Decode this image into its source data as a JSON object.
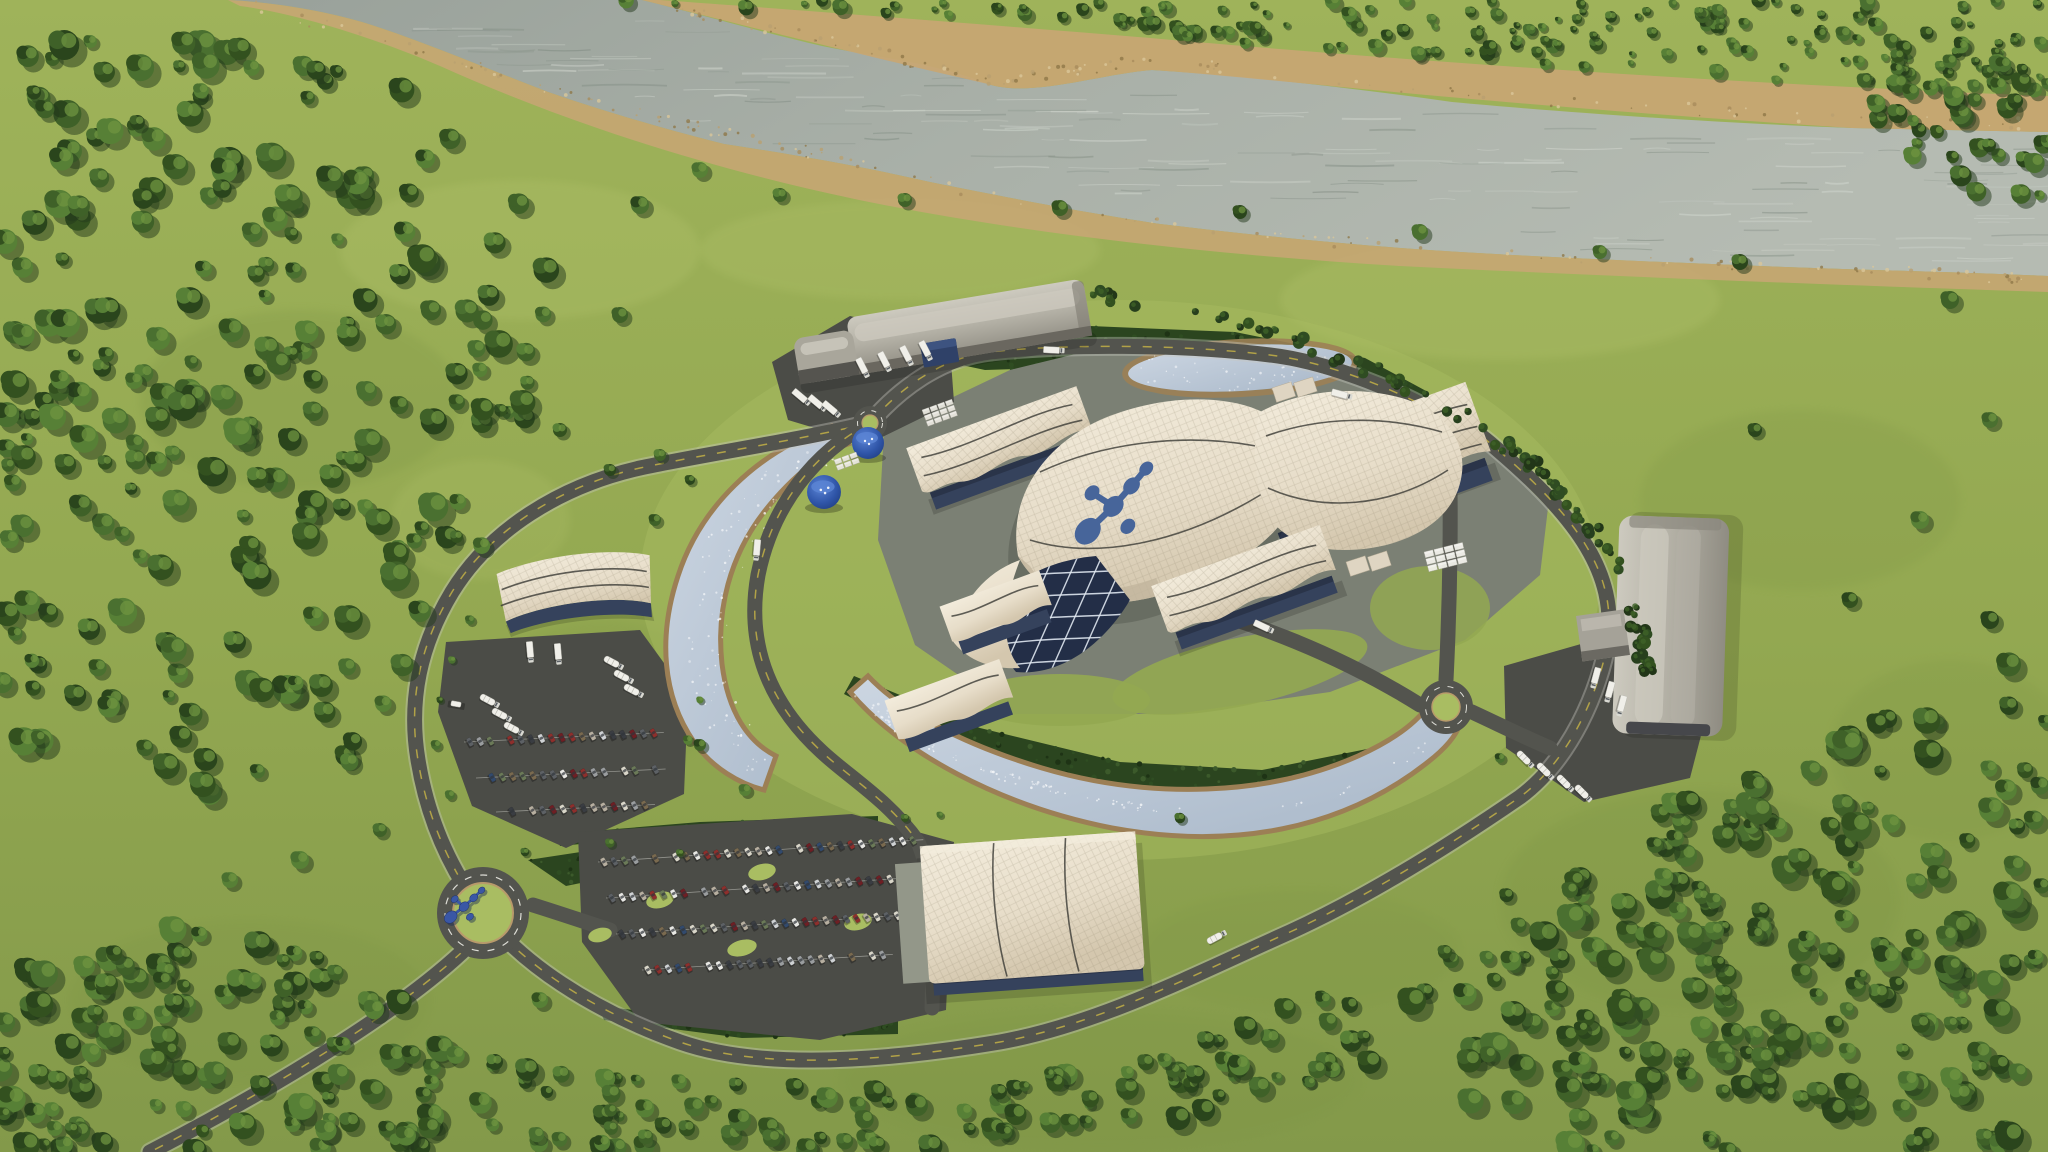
{
  "meta": {
    "description": "Aerial 3D rendering of a circular small-modular-reactor power plant campus set in green countryside beside a wide gray river. A swooping cream-tiled main reactor building carries a dark blue molecule logo; wavy-roofed turbine halls, gray quonset warehouses, cooling ponds, tree belts, roundabouts, truck yards and car parking lots fill the ring.",
    "visible_text": "none"
  },
  "colors": {
    "grass_base": "#93a851",
    "grass_light": "#a9bd62",
    "grass_dark": "#7d9444",
    "field_light": "#b3c36c",
    "forest_palette": [
      "#33511f",
      "#3f6128",
      "#4a7030",
      "#578036",
      "#2a451c"
    ],
    "tree_highlight": "#6f9440",
    "hedge_dark": "#2b451f",
    "hedge_dot_dark": "#1e3315",
    "hedge_dot_light": "#3c5a2b",
    "river_water": "#a3aaa2",
    "river_water_light": "#bfc5bd",
    "river_streak": "#d3d8d0",
    "sand": "#c7a673",
    "sand_dark": "#9c7f55",
    "road_asphalt": "#53544e",
    "lot_asphalt": "#4b4c47",
    "road_yellow": "#c9b546",
    "road_edge": "#c9c8c0",
    "pad_concrete": "#7b8074",
    "pad_light": "#939789",
    "roof_cream": "#e7ddc9",
    "roof_shadow": "#c2b59e",
    "roof_light": "#f3ecdc",
    "wall_blue": "#35425c",
    "wall_blue_dark": "#2a3449",
    "glass_dark": "#232e47",
    "glass_line": "#dfe7f0",
    "quonset_light": "#cdcabf",
    "quonset_mid": "#a9a69b",
    "quonset_dark": "#8f8c82",
    "pond_water": "#c3cedb",
    "pond_deep": "#a9b8c9",
    "pond_edge": "#9c7f55",
    "tank_blue": "#2c4f9e",
    "tank_blue_light": "#5b84d4",
    "logo_blue": "#47659a",
    "sculpture_blue": "#3a57a5",
    "truck_white": "#f0efe9",
    "truck_cab": "#d9d9d2",
    "car_colors": [
      "#e8e8e4",
      "#cfd2d4",
      "#9a9d9f",
      "#5d6165",
      "#8e2f2c",
      "#6e1f24",
      "#b7afa0",
      "#6b7a58",
      "#324a6d",
      "#7a6a4f",
      "#3a3d42",
      "#d9d6c9"
    ]
  },
  "scene": {
    "river": {
      "label": "river with sandy rocky banks",
      "position": "top of image, flowing from upper left to right"
    },
    "campus": {
      "label": "circular power plant site ringed by a perimeter road and dark evergreen hedges"
    },
    "buildings": [
      {
        "name": "main-reactor-building",
        "style": "overlapping swooping cream tiled shells with glass diagrid atrium",
        "logo": "dark blue molecule emblem on roof"
      },
      {
        "name": "turbine-hall-northwest",
        "style": "wavy cream canopy roof over dark blue walls"
      },
      {
        "name": "turbine-hall-east",
        "style": "large wavy cream canopy roof over dark blue walls"
      },
      {
        "name": "hall-south-center",
        "style": "wavy cream canopy roof over dark blue walls"
      },
      {
        "name": "small-hall-southwest-1",
        "style": "small wavy canopy hall"
      },
      {
        "name": "small-hall-southwest-2",
        "style": "small wavy canopy hall"
      },
      {
        "name": "warehouse-north",
        "style": "long gray quonset warehouse with truck docks and blue container"
      },
      {
        "name": "warehouse-east",
        "style": "long gray quonset warehouse with truck yard and annex"
      },
      {
        "name": "office-building-west",
        "style": "white fan canopy over blue glass, truck docks"
      },
      {
        "name": "visitor-building-south",
        "style": "large cream tiled canopy with blue glass southwest wall"
      }
    ],
    "water_features": [
      {
        "name": "pond-northeast",
        "shape": "flattened oval"
      },
      {
        "name": "cooling-channel-west",
        "shape": "C-shaped crescent"
      },
      {
        "name": "cooling-pond-south",
        "shape": "long crescent"
      }
    ],
    "landmark": {
      "name": "logo-sculpture",
      "label": "dark blue molecule sculpture on southwest roundabout"
    },
    "counts": {
      "roundabouts": 3,
      "blue_storage_tanks": 2,
      "cars_main_lot_approx": 113,
      "cars_west_lot_approx": 52,
      "trucks_visible_approx": 28
    }
  }
}
